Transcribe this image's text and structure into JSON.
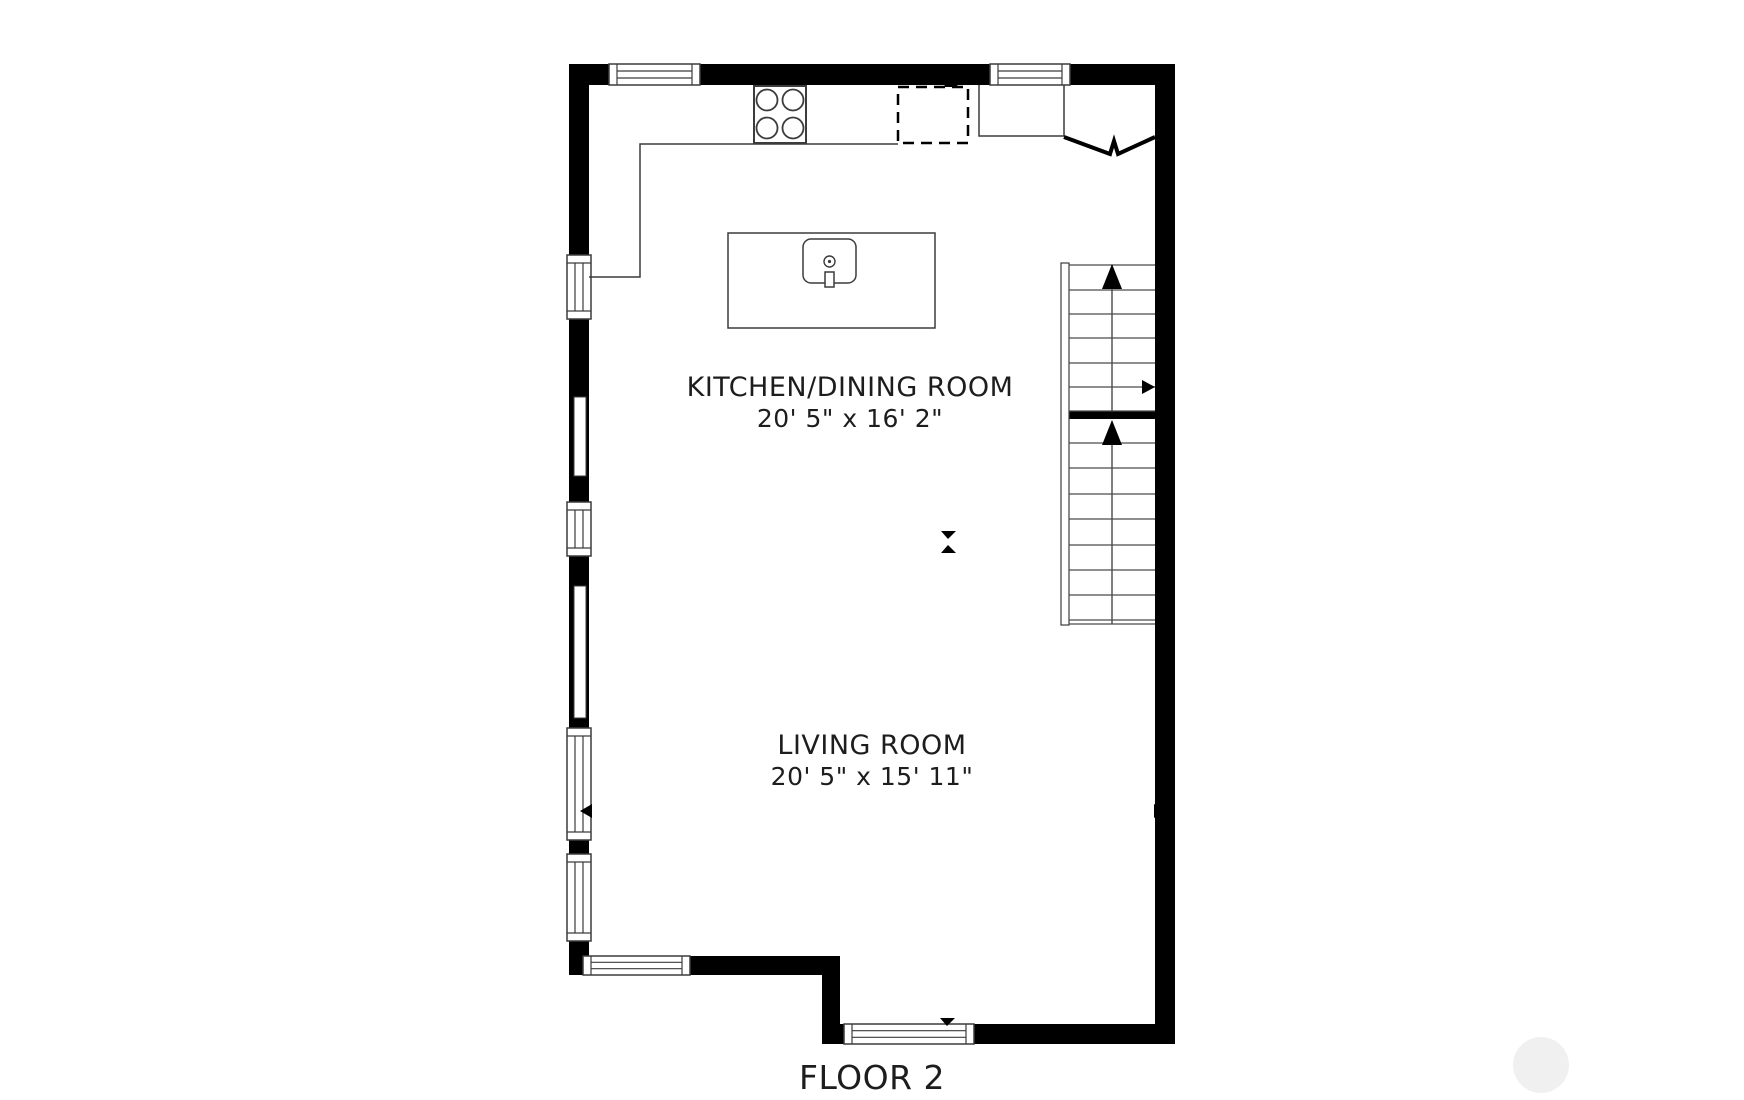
{
  "title": "FLOOR 2",
  "rooms": [
    {
      "name": "KITCHEN/DINING ROOM",
      "dimensions": "20' 5\" x 16' 2\""
    },
    {
      "name": "LIVING ROOM",
      "dimensions": "20' 5\" x 15' 11\""
    }
  ],
  "colors": {
    "wall": "#000000",
    "line": "#3c3c3c",
    "tread": "#4a4a4a",
    "background": "#ffffff",
    "text": "#1d1d1d",
    "watermark": "#f0f0f0"
  },
  "plan": {
    "canvas": {
      "width": 1744,
      "height": 1100
    },
    "walls": [
      {
        "x": 569,
        "y": 64,
        "w": 40,
        "h": 21,
        "name": "top-wall-seg-1"
      },
      {
        "x": 700,
        "y": 64,
        "w": 290,
        "h": 21,
        "name": "top-wall-seg-2"
      },
      {
        "x": 1070,
        "y": 64,
        "w": 105,
        "h": 21,
        "name": "top-wall-seg-3"
      },
      {
        "x": 569,
        "y": 64,
        "w": 20,
        "h": 191,
        "name": "left-wall-seg-1"
      },
      {
        "x": 569,
        "y": 319,
        "w": 20,
        "h": 183,
        "name": "left-wall-seg-2"
      },
      {
        "x": 569,
        "y": 556,
        "w": 20,
        "h": 172,
        "name": "left-wall-seg-3"
      },
      {
        "x": 569,
        "y": 840,
        "w": 20,
        "h": 14,
        "name": "left-wall-seg-4"
      },
      {
        "x": 569,
        "y": 941,
        "w": 20,
        "h": 34,
        "name": "left-wall-seg-5"
      },
      {
        "x": 1155,
        "y": 64,
        "w": 20,
        "h": 980,
        "name": "right-wall"
      },
      {
        "x": 569,
        "y": 956,
        "w": 14,
        "h": 19,
        "name": "bottom-wall-upper-seg-1"
      },
      {
        "x": 690,
        "y": 956,
        "w": 150,
        "h": 19,
        "name": "bottom-wall-upper-seg-2"
      },
      {
        "x": 822,
        "y": 956,
        "w": 18,
        "h": 88,
        "name": "bottom-wall-jog"
      },
      {
        "x": 822,
        "y": 1024,
        "w": 22,
        "h": 20,
        "name": "bottom-wall-lower-seg-1"
      },
      {
        "x": 974,
        "y": 1024,
        "w": 201,
        "h": 20,
        "name": "bottom-wall-lower-seg-2"
      },
      {
        "x": 1069,
        "y": 411,
        "w": 86,
        "h": 8,
        "name": "stairs-landing-divider"
      }
    ],
    "window_slits": [
      {
        "x": 574,
        "y": 397,
        "w": 12,
        "h": 79,
        "name": "left-window-slit-1"
      },
      {
        "x": 574,
        "y": 586,
        "w": 12,
        "h": 132,
        "name": "left-window-slit-2"
      }
    ],
    "windows": [
      {
        "x": 609,
        "y": 64,
        "w": 91,
        "h": 21,
        "orient": "h",
        "name": "top-window-1"
      },
      {
        "x": 990,
        "y": 64,
        "w": 80,
        "h": 21,
        "orient": "h",
        "name": "top-window-2"
      },
      {
        "x": 567,
        "y": 255,
        "w": 24,
        "h": 64,
        "orient": "v",
        "name": "left-window-1"
      },
      {
        "x": 567,
        "y": 502,
        "w": 24,
        "h": 54,
        "orient": "v",
        "name": "left-window-2"
      },
      {
        "x": 567,
        "y": 728,
        "w": 24,
        "h": 112,
        "orient": "v",
        "name": "left-window-3"
      },
      {
        "x": 567,
        "y": 854,
        "w": 24,
        "h": 87,
        "orient": "v",
        "name": "left-window-4"
      },
      {
        "x": 583,
        "y": 956,
        "w": 107,
        "h": 19,
        "orient": "h",
        "name": "bottom-window-1"
      },
      {
        "x": 844,
        "y": 1024,
        "w": 130,
        "h": 20,
        "orient": "h",
        "name": "bottom-window-2"
      }
    ],
    "counter_lines": [
      {
        "points": [
          [
            898,
            144
          ],
          [
            640,
            144
          ],
          [
            640,
            277
          ],
          [
            589,
            277
          ]
        ],
        "w": 1.5,
        "name": "kitchen-counter-left"
      },
      {
        "points": [
          [
            979,
            85
          ],
          [
            979,
            136
          ],
          [
            1064,
            136
          ],
          [
            1064,
            85
          ]
        ],
        "w": 1.5,
        "name": "kitchen-counter-right"
      }
    ],
    "bifold": {
      "points": [
        [
          1064,
          137
        ],
        [
          1110,
          154
        ],
        [
          1114,
          141
        ],
        [
          1118,
          154
        ],
        [
          1155,
          137
        ]
      ],
      "w": 4,
      "name": "bifold-door"
    },
    "fixtures": {
      "island": {
        "x": 728,
        "y": 233,
        "w": 207,
        "h": 95,
        "sw": 1.5,
        "name": "kitchen-island"
      },
      "sink": {
        "x": 803,
        "y": 239,
        "w": 53,
        "h": 44,
        "rx": 8,
        "sw": 1.5,
        "name": "sink"
      },
      "faucet": {
        "x": 825,
        "y": 272,
        "w": 9,
        "h": 15,
        "sw": 1.5,
        "name": "sink-faucet"
      },
      "stove": {
        "x": 754,
        "y": 86,
        "w": 52,
        "h": 57,
        "sw": 2,
        "name": "stove-cooktop"
      },
      "appliance": {
        "x": 898,
        "y": 87,
        "w": 70,
        "h": 56,
        "sw": 2.5,
        "dash": "11,7",
        "name": "refrigerator-dashed"
      },
      "railing": {
        "x": 1061,
        "y": 263,
        "w": 8,
        "h": 362,
        "sw": 1.2,
        "name": "stairs-railing"
      },
      "burners": [
        {
          "cx": 767,
          "cy": 100
        },
        {
          "cx": 793,
          "cy": 100
        },
        {
          "cx": 767,
          "cy": 128
        },
        {
          "cx": 793,
          "cy": 128
        }
      ],
      "burner_r": 10.5,
      "sink_drain": {
        "cx": 829.5,
        "cy": 261.5,
        "r": 5.5,
        "dot": 1.6,
        "name": "sink-drain"
      }
    },
    "stairs": {
      "x1": 1069,
      "x2": 1155,
      "center_x": 1112,
      "sw": 1.2,
      "upper_treads": [
        265,
        290,
        314,
        338,
        363,
        387,
        411
      ],
      "lower_treads": [
        443,
        468,
        494,
        519,
        545,
        570,
        595,
        620,
        624
      ],
      "upper_line": {
        "y1": 274,
        "y2": 411
      },
      "lower_line": {
        "y1": 430,
        "y2": 624
      }
    },
    "markers": [
      {
        "points": [
          [
            951,
            79
          ],
          [
            943,
            87
          ],
          [
            959,
            87
          ]
        ],
        "name": "arrow-up-appliance-icon"
      },
      {
        "points": [
          [
            1112,
            264
          ],
          [
            1102,
            289
          ],
          [
            1122,
            289
          ]
        ],
        "name": "stairs-up-arrow-upper-icon"
      },
      {
        "points": [
          [
            1112,
            420
          ],
          [
            1102,
            445
          ],
          [
            1122,
            445
          ]
        ],
        "name": "stairs-up-arrow-lower-icon"
      },
      {
        "points": [
          [
            1155,
            387
          ],
          [
            1142,
            380
          ],
          [
            1142,
            394
          ]
        ],
        "name": "stairs-right-arrow-icon"
      },
      {
        "points": [
          [
            941,
            531
          ],
          [
            956,
            531
          ],
          [
            948,
            539
          ]
        ],
        "name": "arrow-down-mid-icon"
      },
      {
        "points": [
          [
            948,
            545
          ],
          [
            941,
            553
          ],
          [
            956,
            553
          ]
        ],
        "name": "arrow-up-mid-icon"
      },
      {
        "points": [
          [
            580,
            811
          ],
          [
            592,
            804
          ],
          [
            592,
            818
          ]
        ],
        "name": "arrow-left-wall-icon"
      },
      {
        "points": [
          [
            1166,
            811
          ],
          [
            1154,
            804
          ],
          [
            1154,
            818
          ]
        ],
        "name": "arrow-right-wall-icon"
      },
      {
        "points": [
          [
            940,
            1018
          ],
          [
            955,
            1018
          ],
          [
            947,
            1026
          ]
        ],
        "name": "arrow-down-bottom-window-icon"
      }
    ],
    "watermark_circle": {
      "cx": 1541,
      "cy": 1065,
      "r": 28
    }
  }
}
